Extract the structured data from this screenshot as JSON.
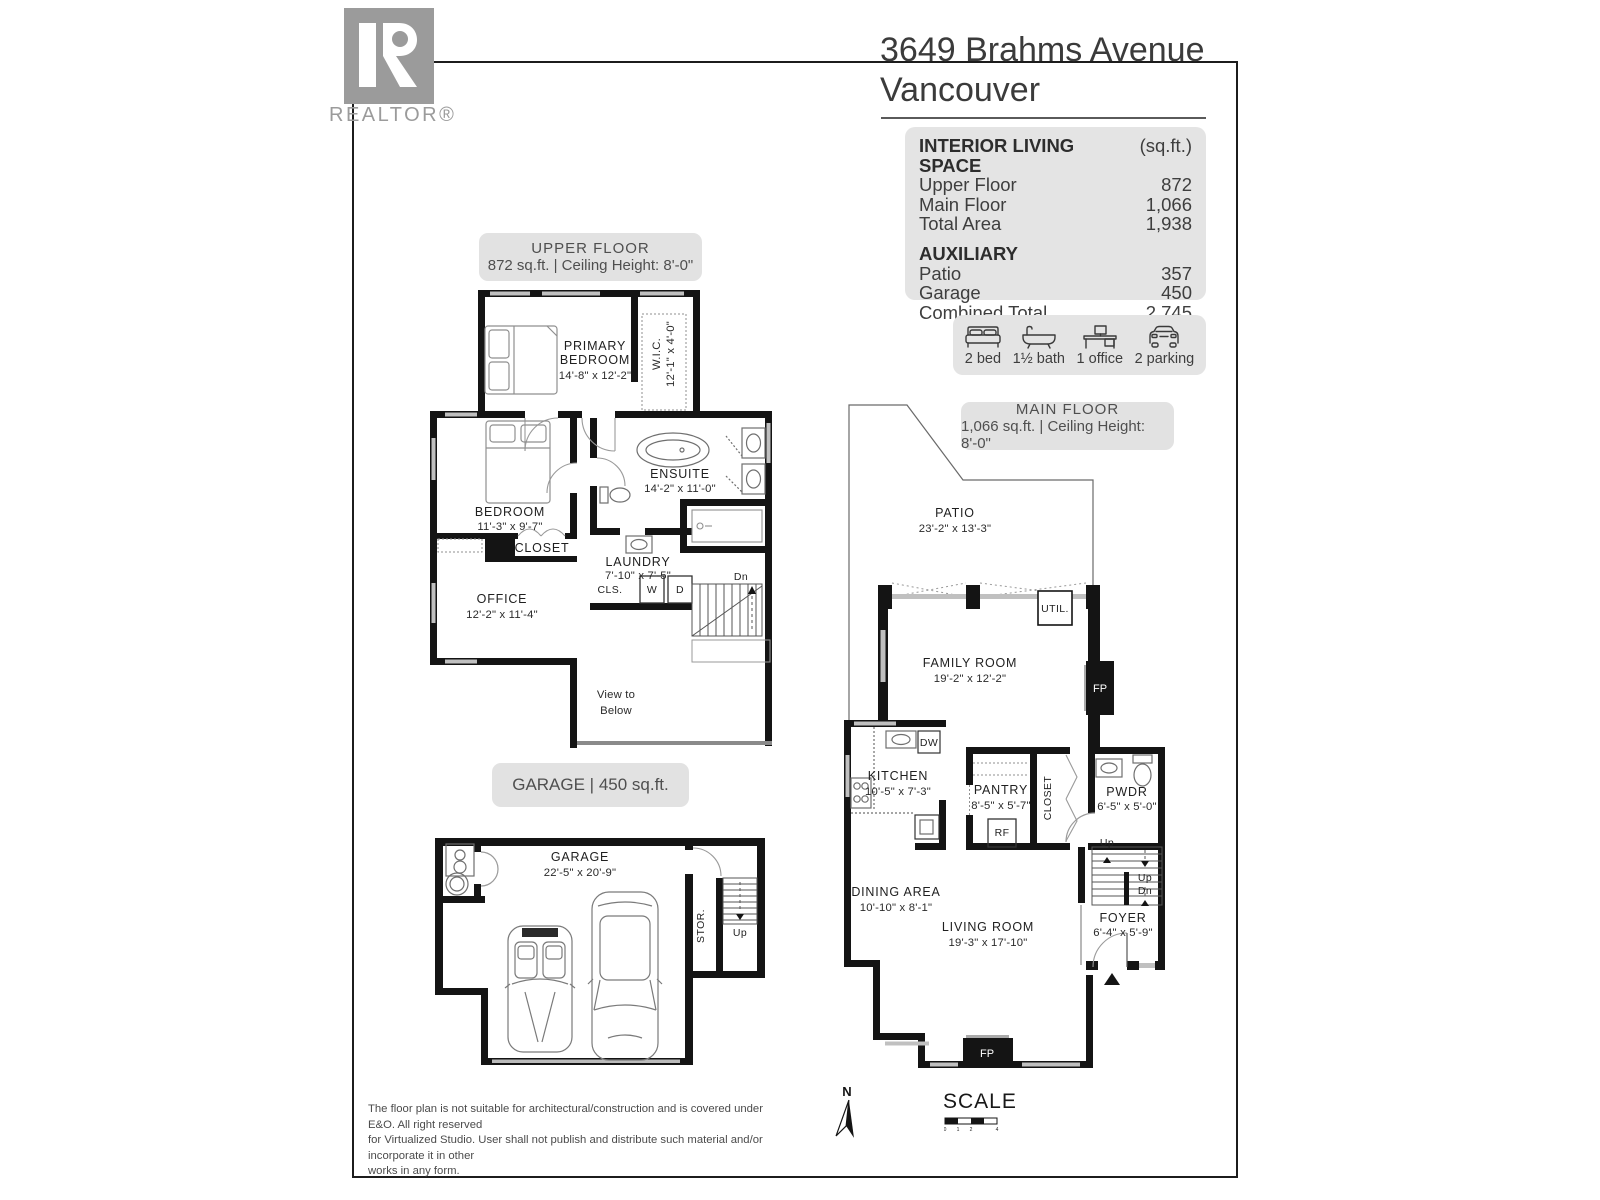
{
  "brand": {
    "logo_letter": "R",
    "logo_label": "REALTOR®"
  },
  "header": {
    "address_line1": "3649 Brahms Avenue",
    "address_line2": "Vancouver"
  },
  "colors": {
    "wall": "#141414",
    "card_bg": "#e4e4e4",
    "logo_gray": "#9b9b9b",
    "window_gray": "#c0c0c0"
  },
  "stats": {
    "interior": {
      "heading": "INTERIOR LIVING SPACE",
      "unit": "(sq.ft.)",
      "rows": [
        {
          "label": "Upper Floor",
          "value": "872"
        },
        {
          "label": "Main Floor",
          "value": "1,066"
        },
        {
          "label": "Total Area",
          "value": "1,938"
        }
      ]
    },
    "auxiliary": {
      "heading": "AUXILIARY",
      "rows": [
        {
          "label": "Patio",
          "value": "357"
        },
        {
          "label": "Garage",
          "value": "450"
        },
        {
          "label": "Combined Total",
          "value": "2,745"
        }
      ]
    }
  },
  "features": [
    {
      "icon": "bed-icon",
      "label": "2 bed"
    },
    {
      "icon": "bath-icon",
      "label": "1½ bath"
    },
    {
      "icon": "office-icon",
      "label": "1 office"
    },
    {
      "icon": "parking-icon",
      "label": "2 parking"
    }
  ],
  "floors": {
    "upper": {
      "pill_title": "UPPER FLOOR",
      "pill_subtitle": "872 sq.ft. | Ceiling Height: 8'-0\"",
      "rooms": {
        "primary": {
          "l1": "PRIMARY",
          "l2": "BEDROOM",
          "dims": "14'-8\" x 12'-2\""
        },
        "wic": {
          "name": "W.I.C.",
          "dims": "12'-1\" x 4'-0\""
        },
        "ensuite": {
          "name": "ENSUITE",
          "dims": "14'-2\" x 11'-0\""
        },
        "bedroom": {
          "name": "BEDROOM",
          "dims": "11'-3\" x 9'-7\""
        },
        "closet": {
          "name": "CLOSET"
        },
        "laundry": {
          "name": "LAUNDRY",
          "dims": "7'-10\" x 7'-5\""
        },
        "cls": {
          "name": "CLS."
        },
        "washer": {
          "name": "W"
        },
        "dryer": {
          "name": "D"
        },
        "office": {
          "name": "OFFICE",
          "dims": "12'-2\" x 11'-4\""
        },
        "dn": {
          "name": "Dn"
        },
        "view": {
          "l1": "View to",
          "l2": "Below"
        }
      }
    },
    "main": {
      "pill_title": "MAIN FLOOR",
      "pill_subtitle": "1,066 sq.ft. | Ceiling Height: 8'-0\"",
      "rooms": {
        "patio": {
          "name": "PATIO",
          "dims": "23'-2\" x 13'-3\""
        },
        "util": {
          "name": "UTIL."
        },
        "family": {
          "name": "FAMILY ROOM",
          "dims": "19'-2\" x 12'-2\""
        },
        "fireplace": {
          "name": "FP"
        },
        "kitchen": {
          "name": "KITCHEN",
          "dims": "10'-5\" x 7'-3\""
        },
        "dw": {
          "name": "DW"
        },
        "pantry": {
          "name": "PANTRY",
          "dims": "8'-5\" x 5'-7\""
        },
        "rf": {
          "name": "RF"
        },
        "closet": {
          "name": "CLOSET"
        },
        "pwdr": {
          "name": "PWDR",
          "dims": "6'-5\" x 5'-0\""
        },
        "up": {
          "name": "Up"
        },
        "dn": {
          "name": "Dn"
        },
        "dining": {
          "name": "DINING AREA",
          "dims": "10'-10\" x 8'-1\""
        },
        "living": {
          "name": "LIVING ROOM",
          "dims": "19'-3\" x 17'-10\""
        },
        "foyer": {
          "name": "FOYER",
          "dims": "6'-4\" x 5'-9\""
        }
      }
    },
    "garage": {
      "pill_title": "GARAGE | 450 sq.ft.",
      "rooms": {
        "garage": {
          "name": "GARAGE",
          "dims": "22'-5\" x 20'-9\""
        },
        "stor": {
          "name": "STOR."
        },
        "up": {
          "name": "Up"
        }
      }
    }
  },
  "footer": {
    "disclaimer": [
      "The floor plan is not suitable for architectural/construction and is covered under E&O. All right reserved",
      "for Virtualized Studio. User shall not publish and distribute such material and/or incorporate it in other",
      "works in any form."
    ],
    "north_label": "N",
    "scale_label": "SCALE",
    "scale_ticks": [
      "0",
      "1",
      "2",
      "4"
    ]
  }
}
